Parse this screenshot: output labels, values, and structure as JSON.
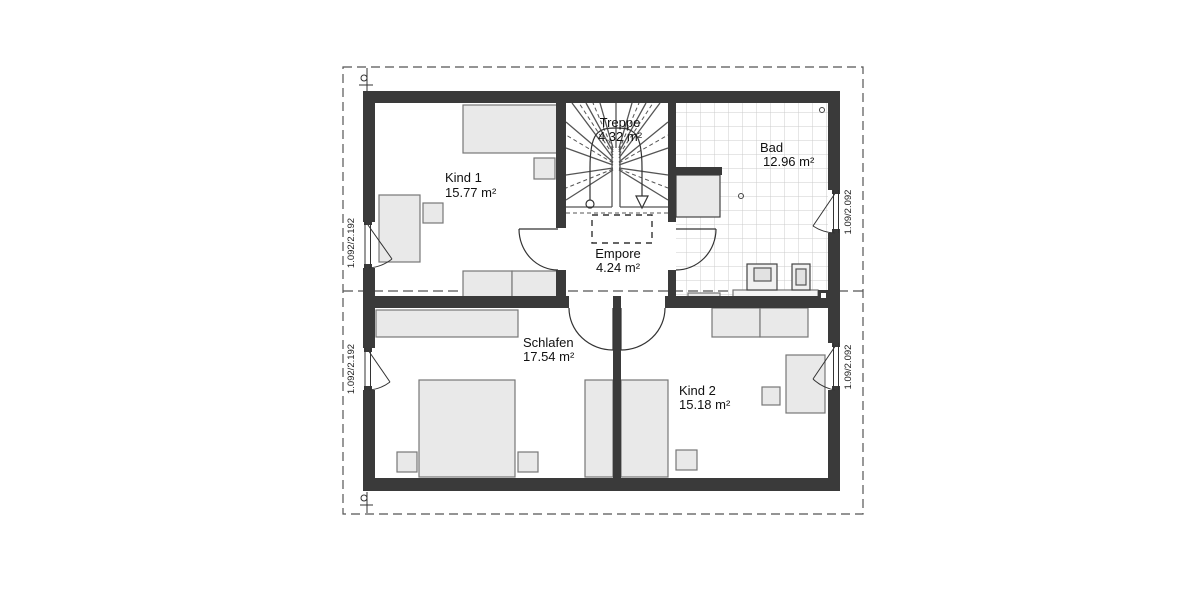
{
  "plan": {
    "title": "floor-plan-upper-storey",
    "rooms": [
      {
        "id": "kind1",
        "label": "Kind 1",
        "area": "15.77 m²"
      },
      {
        "id": "treppe",
        "label": "Treppe",
        "area": "4.32 m²"
      },
      {
        "id": "bad",
        "label": "Bad",
        "area": "12.96 m²"
      },
      {
        "id": "empore",
        "label": "Empore",
        "area": "4.24 m²"
      },
      {
        "id": "schlafen",
        "label": "Schlafen",
        "area": "17.54 m²"
      },
      {
        "id": "kind2",
        "label": "Kind 2",
        "area": "15.18 m²"
      }
    ],
    "windows": [
      {
        "id": "left-top",
        "label": "1.092/2.192"
      },
      {
        "id": "left-bottom",
        "label": "1.092/2.192"
      },
      {
        "id": "right-top",
        "label": "1.09/2.092"
      },
      {
        "id": "right-bottom",
        "label": "1.09/2.092"
      }
    ],
    "colors": {
      "wall": "#3a3a3a",
      "furniture_fill": "#e9e9e9",
      "furniture_stroke": "#777777",
      "tile_line": "#cccccc",
      "outline": "#555555",
      "text": "#111111"
    }
  }
}
